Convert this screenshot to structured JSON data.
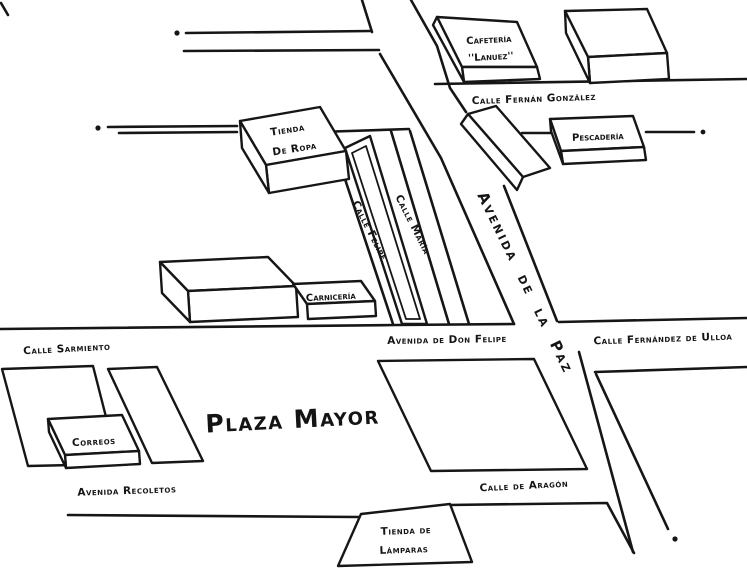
{
  "map": {
    "paper_color": "#ffffff",
    "ink_color": "#161616",
    "streets": {
      "fernan_gonzalez": "Calle Fernán González",
      "felipe": "Calle Felipe",
      "maria": "Calle María",
      "avenida_paz": "Avenida de la Paz",
      "don_felipe": "Avenida de Don Felipe",
      "fernandez_ulloa": "Calle Fernández de Ulloa",
      "sarmiento": "Calle Sarmiento",
      "recoletos": "Avenida Recoletos",
      "aragon": "Calle de Aragón"
    },
    "places": {
      "cafeteria_line1": "Cafetería",
      "cafeteria_line2": "''Lanuez''",
      "pescaderia": "Pescadería",
      "tienda_ropa_line1": "Tienda",
      "tienda_ropa_line2": "De Ropa",
      "carniceria": "Carnicería",
      "correos": "Correos",
      "plaza_mayor": "Plaza Mayor",
      "tienda_lamparas_line1": "Tienda de",
      "tienda_lamparas_line2": "Lámparas"
    }
  }
}
